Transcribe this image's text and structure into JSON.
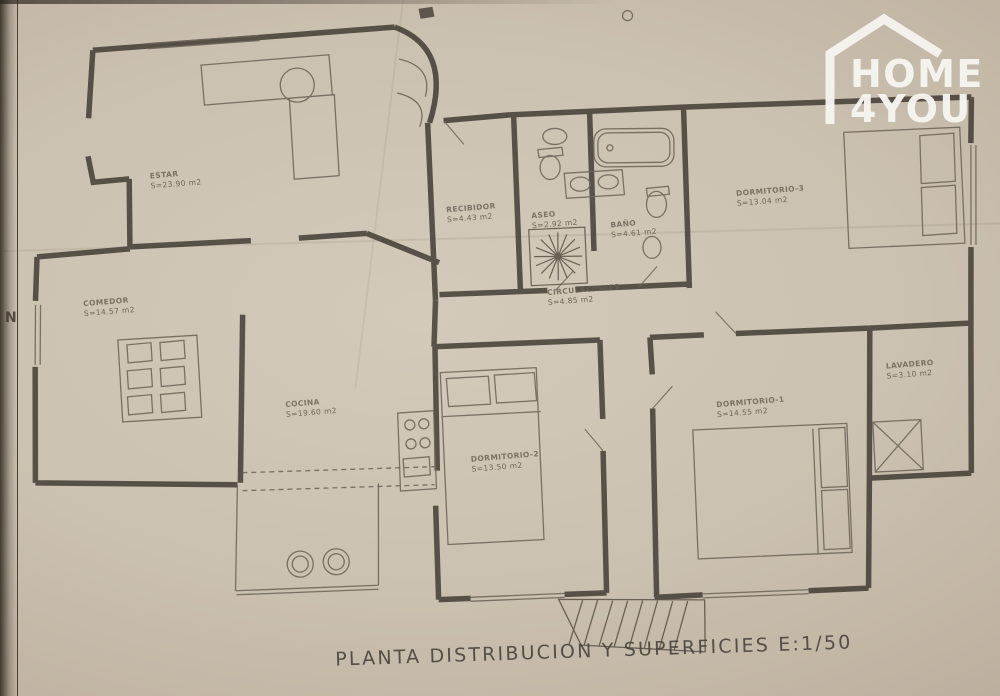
{
  "watermark": {
    "line1": "HOME",
    "line2": "4YOU",
    "color": "#f6f4ef",
    "icon": "house-outline-icon"
  },
  "colors": {
    "paper": "#cbc1b0",
    "ink": "#45403a",
    "label_ink": "#685e52"
  },
  "floor_plan": {
    "title": "PLANTA DISTRIBUCION Y SUPERFICIES E:1/50",
    "north_label": "N",
    "rooms": [
      {
        "name": "ESTAR",
        "area": "S=23.90 m2"
      },
      {
        "name": "COMEDOR",
        "area": "S=14.57 m2"
      },
      {
        "name": "COCINA",
        "area": "S=19.60 m2"
      },
      {
        "name": "RECIBIDOR",
        "area": "S=4.43 m2"
      },
      {
        "name": "ASEO",
        "area": "S=2.92 m2"
      },
      {
        "name": "BAÑO",
        "area": "S=4.61 m2"
      },
      {
        "name": "DORMITORIO-3",
        "area": "S=13.04 m2"
      },
      {
        "name": "CIRCULACIONES",
        "area": "S=4.85 m2"
      },
      {
        "name": "DORMITORIO-2",
        "area": "S=13.50 m2"
      },
      {
        "name": "DORMITORIO-1",
        "area": "S=14.55 m2"
      },
      {
        "name": "LAVADERO",
        "area": "S=3.10 m2"
      }
    ]
  }
}
